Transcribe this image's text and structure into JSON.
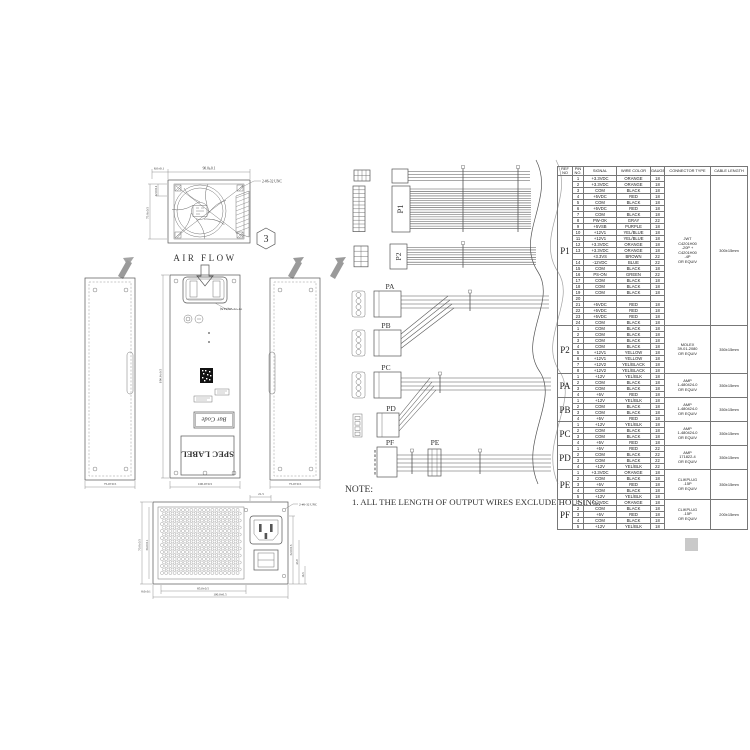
{
  "drawing": {
    "air_flow": "AIR FLOW",
    "balloon": "3",
    "note_label": "NOTE:",
    "note_text": "1. ALL THE LENGTH OF OUTPUT WIRES EXCLUDE HOUSING.",
    "spec_label": "SPEC LABEL",
    "bar_code": "Bar Code",
    "fan_callout": "70*70*25(FAN)"
  },
  "fan_view": {
    "width_dim": "90.0±0.1",
    "offset_dim": "8.0±0.1",
    "height_dim": "75.0±0.5",
    "inner_dim": "12.0±0.1",
    "screw_note": "2-#6-32 UNC"
  },
  "panel_views": {
    "left_width": "75.0±0.5",
    "center_width": "100.0±0.5",
    "right_width": "75.0±0.5",
    "length_dim": "190.0±0.5"
  },
  "rear_view": {
    "top_dim": "21.5",
    "screw_note": "2-#6-32 UNC",
    "left_outer": "70.0±0.5",
    "left_inner": "56.0±0.1",
    "bottom_small": "8.0±0.1",
    "bottom_mid": "85.0±0.5",
    "bottom_outer": "100.0±0.5",
    "right_upper": "52.0±0.5",
    "right_mid": "43.9",
    "right_lower": "16.5"
  },
  "connectors": {
    "p1": "P1",
    "p2": "P2",
    "pa": "PA",
    "pb": "PB",
    "pc": "PC",
    "pd": "PD",
    "pe": "PE",
    "pf": "PF"
  },
  "table": {
    "headers": [
      "REF NO",
      "PIN NO.",
      "SIGNAL",
      "WIRE COLOR",
      "GAUGE",
      "CONNECTOR TYPE",
      "CABLE LENGTH"
    ],
    "sections": [
      {
        "ref": "P1",
        "connector": "JWT\nC4201H00\n-20P +\nC4201H00\n-4P\nOR EQUIV",
        "length": "300±15mm",
        "rows": [
          [
            "1",
            "+3.3VDC",
            "ORANGE",
            "18"
          ],
          [
            "2",
            "+3.3VDC",
            "ORANGE",
            "18"
          ],
          [
            "3",
            "COM",
            "BLACK",
            "18"
          ],
          [
            "4",
            "+5VDC",
            "RED",
            "18"
          ],
          [
            "5",
            "COM",
            "BLACK",
            "18"
          ],
          [
            "6",
            "+5VDC",
            "RED",
            "18"
          ],
          [
            "7",
            "COM",
            "BLACK",
            "18"
          ],
          [
            "8",
            "PW-OK",
            "GRAY",
            "22"
          ],
          [
            "9",
            "+5VSB",
            "PURPLE",
            "18"
          ],
          [
            "10",
            "+12V1",
            "YEL/BLUE",
            "18"
          ],
          [
            "11",
            "+12V1",
            "YEL/BLUE",
            "18"
          ],
          [
            "12",
            "+3.3VDC",
            "ORANGE",
            "18"
          ],
          [
            "13",
            "+3.3VDC",
            "ORANGE",
            "18"
          ],
          [
            "",
            "+3.3VS",
            "BROWN",
            "22"
          ],
          [
            "14",
            "-12VDC",
            "BLUE",
            "22"
          ],
          [
            "15",
            "COM",
            "BLACK",
            "18"
          ],
          [
            "16",
            "PS-ON",
            "GREEN",
            "22"
          ],
          [
            "17",
            "COM",
            "BLACK",
            "18"
          ],
          [
            "18",
            "COM",
            "BLACK",
            "18"
          ],
          [
            "19",
            "COM",
            "BLACK",
            "18"
          ],
          [
            "20",
            "",
            "",
            ""
          ],
          [
            "21",
            "+5VDC",
            "RED",
            "18"
          ],
          [
            "22",
            "+5VDC",
            "RED",
            "18"
          ],
          [
            "23",
            "+5VDC",
            "RED",
            "18"
          ],
          [
            "24",
            "COM",
            "BLACK",
            "18"
          ]
        ]
      },
      {
        "ref": "P2",
        "connector": "MOLEX\n39-01-2080\nOR EQUIV",
        "length": "350±15mm",
        "rows": [
          [
            "1",
            "COM",
            "BLACK",
            "18"
          ],
          [
            "2",
            "COM",
            "BLACK",
            "18"
          ],
          [
            "3",
            "COM",
            "BLACK",
            "18"
          ],
          [
            "4",
            "COM",
            "BLACK",
            "18"
          ],
          [
            "5",
            "+12V1",
            "YELLOW",
            "18"
          ],
          [
            "6",
            "+12V1",
            "YELLOW",
            "18"
          ],
          [
            "7",
            "+12V2",
            "YEL/BLACK",
            "18"
          ],
          [
            "8",
            "+12V2",
            "YEL/BLACK",
            "18"
          ]
        ]
      },
      {
        "ref": "PA",
        "connector": "AMP\n1-480424-0\nOR EQUIV",
        "length": "350±15mm",
        "rows": [
          [
            "1",
            "+12V",
            "YEL/BLK",
            "18"
          ],
          [
            "2",
            "COM",
            "BLACK",
            "18"
          ],
          [
            "3",
            "COM",
            "BLACK",
            "18"
          ],
          [
            "4",
            "+5V",
            "RED",
            "18"
          ]
        ]
      },
      {
        "ref": "PB",
        "connector": "AMP\n1-480424-0\nOR EQUIV",
        "length": "350±15mm",
        "rows": [
          [
            "1",
            "+12V",
            "YEL/BLK",
            "18"
          ],
          [
            "2",
            "COM",
            "BLACK",
            "18"
          ],
          [
            "3",
            "COM",
            "BLACK",
            "18"
          ],
          [
            "4",
            "+5V",
            "RED",
            "18"
          ]
        ]
      },
      {
        "ref": "PC",
        "connector": "AMP\n1-480424-0\nOR EQUIV",
        "length": "350±15mm",
        "rows": [
          [
            "1",
            "+12V",
            "YEL/BLK",
            "18"
          ],
          [
            "2",
            "COM",
            "BLACK",
            "18"
          ],
          [
            "3",
            "COM",
            "BLACK",
            "18"
          ],
          [
            "4",
            "+5V",
            "RED",
            "18"
          ]
        ]
      },
      {
        "ref": "PD",
        "connector": "AMP\n171822-4\nOR EQUIV",
        "length": "350±15mm",
        "rows": [
          [
            "1",
            "+5V",
            "RED",
            "22"
          ],
          [
            "2",
            "COM",
            "BLACK",
            "22"
          ],
          [
            "3",
            "COM",
            "BLACK",
            "22"
          ],
          [
            "4",
            "+12V",
            "YEL/BLK",
            "22"
          ]
        ]
      },
      {
        "ref": "PE",
        "connector": "CLIKPLUG\n-15P\nOR EQUIV",
        "length": "350±15mm",
        "rows": [
          [
            "1",
            "+3.3VDC",
            "ORANGE",
            "18"
          ],
          [
            "2",
            "COM",
            "BLACK",
            "18"
          ],
          [
            "3",
            "+5V",
            "RED",
            "18"
          ],
          [
            "4",
            "COM",
            "BLACK",
            "18"
          ],
          [
            "5",
            "+12V",
            "YEL/BLK",
            "18"
          ]
        ]
      },
      {
        "ref": "PF",
        "connector": "CLIKPLUG\n-15P\nOR EQUIV",
        "length": "200±15mm",
        "rows": [
          [
            "1",
            "+3.3VDC",
            "ORANGE",
            "18"
          ],
          [
            "2",
            "COM",
            "BLACK",
            "18"
          ],
          [
            "3",
            "+5V",
            "RED",
            "18"
          ],
          [
            "4",
            "COM",
            "BLACK",
            "18"
          ],
          [
            "5",
            "+12V",
            "YEL/BLK",
            "18"
          ]
        ]
      }
    ]
  }
}
